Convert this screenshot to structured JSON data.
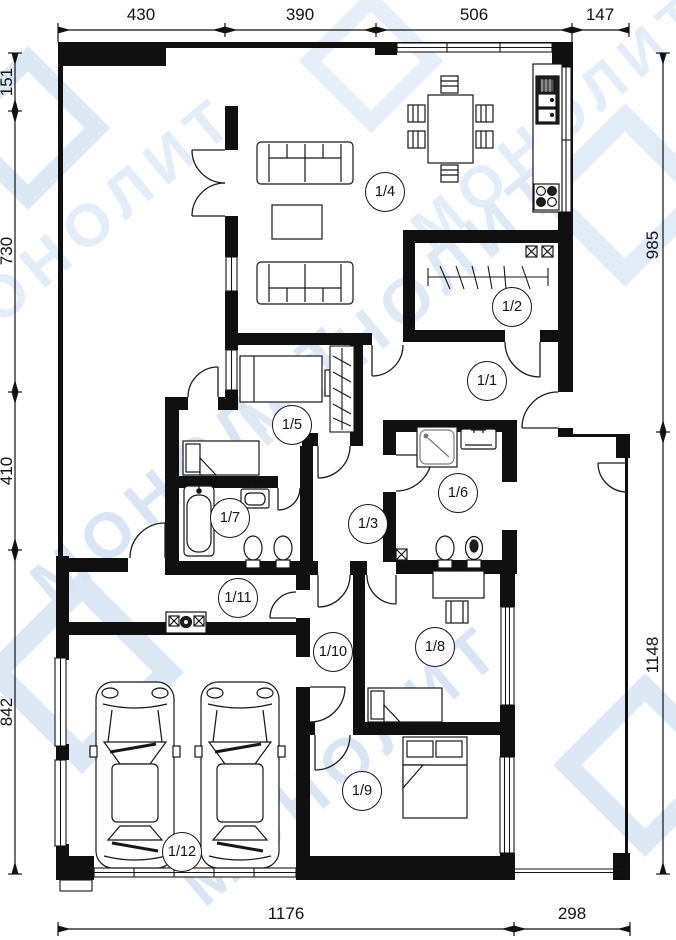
{
  "watermark": {
    "text": "МОНОЛИТ",
    "color": "#d9e5f2"
  },
  "dimensions": {
    "top": [
      "430",
      "390",
      "506",
      "147"
    ],
    "left": [
      "151",
      "730",
      "410",
      "842"
    ],
    "right": [
      "985",
      "1148"
    ],
    "bottom": [
      "1176",
      "298"
    ]
  },
  "rooms": [
    {
      "id": "room-1-1",
      "label": "1/1"
    },
    {
      "id": "room-1-2",
      "label": "1/2"
    },
    {
      "id": "room-1-3",
      "label": "1/3"
    },
    {
      "id": "room-1-4",
      "label": "1/4"
    },
    {
      "id": "room-1-5",
      "label": "1/5"
    },
    {
      "id": "room-1-6",
      "label": "1/6"
    },
    {
      "id": "room-1-7",
      "label": "1/7"
    },
    {
      "id": "room-1-8",
      "label": "1/8"
    },
    {
      "id": "room-1-9",
      "label": "1/9"
    },
    {
      "id": "room-1-10",
      "label": "1/10"
    },
    {
      "id": "room-1-11",
      "label": "1/11"
    },
    {
      "id": "room-1-12",
      "label": "1/12"
    }
  ]
}
